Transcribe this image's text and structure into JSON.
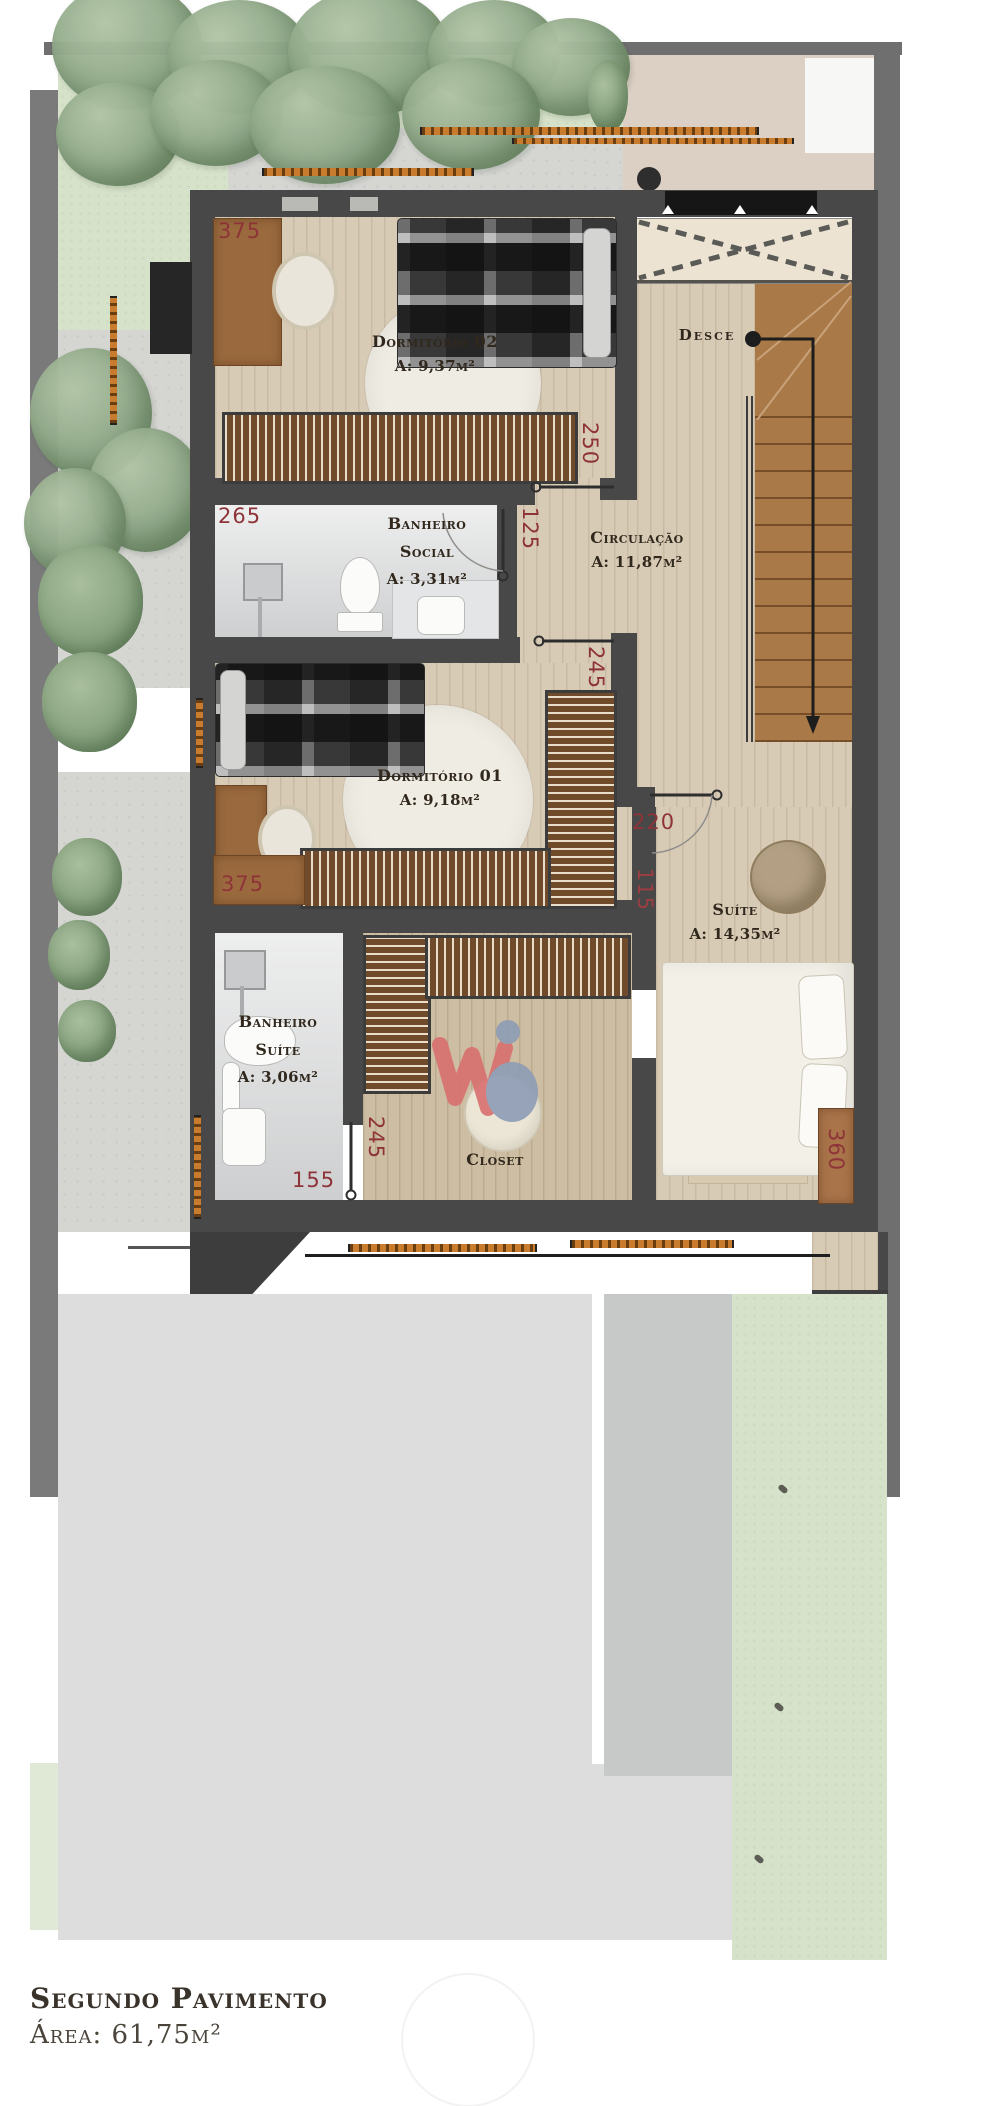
{
  "plan": {
    "rooms": {
      "dorm02": {
        "name": "Dormitório 02",
        "area": "A: 9,37m²"
      },
      "banheiro_social": {
        "name_line1": "Banheiro",
        "name_line2": "Social",
        "area": "A: 3,31m²"
      },
      "circulacao": {
        "name": "Circulação",
        "area": "A: 11,87m²"
      },
      "dorm01": {
        "name": "Dormitório 01",
        "area": "A: 9,18m²"
      },
      "suite": {
        "name": "Suíte",
        "area": "A: 14,35m²"
      },
      "banheiro_suite": {
        "name_line1": "Banheiro",
        "name_line2": "Suíte",
        "area": "A: 3,06m²"
      },
      "closet": {
        "name": "Closet"
      }
    },
    "stairs": {
      "label": "Desce"
    },
    "dimensions": {
      "dorm02_width": "375",
      "circ_top": "250",
      "hall_jog": "125",
      "banheiro_social_width": "265",
      "dorm01_door": "245",
      "suite_door": "220",
      "suite_wall": "115",
      "dorm01_width": "375",
      "closet_door": "245",
      "banheiro_suite_width": "155",
      "suite_depth": "360"
    }
  },
  "footer": {
    "title": "Segundo Pavimento",
    "area": "Área: 61,75m²"
  },
  "colors": {
    "wall": "#484848",
    "dimension_text": "#8e3338",
    "label_text": "#31281d",
    "wood_floor": "#d8cbb6",
    "stair_wood": "#a97947",
    "grass": "#d7e2ca",
    "concrete": "#d5d5d2",
    "roof_gray": "#dcdddc",
    "tape_orange": "#c97c2d"
  }
}
